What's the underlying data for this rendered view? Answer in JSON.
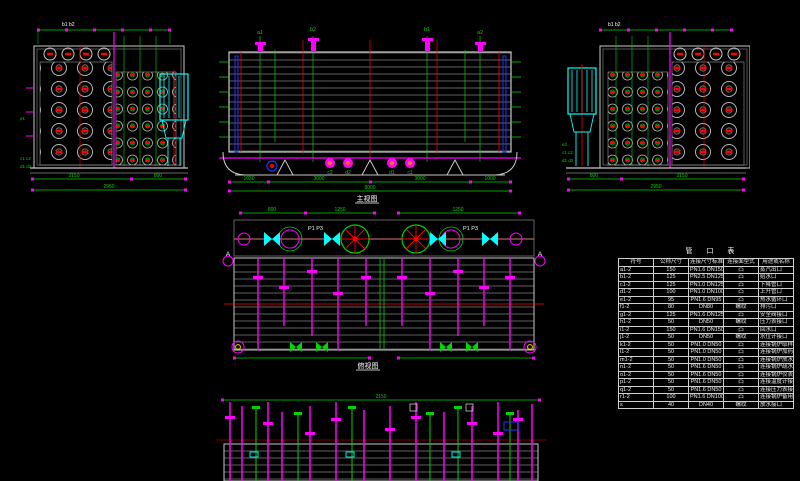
{
  "colors": {
    "background": "#000000",
    "dimension_green": "#00d400",
    "pipe_magenta": "#ff00ff",
    "centerline_red": "#ff0000",
    "economizer_cyan": "#00ffff",
    "tube_gray": "#b0b0b0",
    "outline_white": "#ffffff",
    "accent_blue": "#2233ff",
    "accent_yellow": "#ffd400"
  },
  "views": {
    "left_end": {
      "labels": {
        "t1": "b1 b2",
        "l1": "e1",
        "l2": "c1 c2",
        "l3": "d1 d2"
      },
      "dims": {
        "a": "2150",
        "b": "800",
        "total": "2950"
      }
    },
    "main": {
      "label": "主视图",
      "nozzles": {
        "n1": "a1",
        "n2": "b2",
        "n3": "b1",
        "n4": "a2",
        "f1": "c2",
        "f2": "d2",
        "f3": "d1",
        "f4": "c1"
      },
      "dims": {
        "s1": "1030",
        "s2": "3000",
        "s3": "3000",
        "s4": "1000",
        "total": "8000"
      }
    },
    "right_end": {
      "labels": {
        "t1": "b1 b2",
        "l1": "e2",
        "l2": "c1 c2",
        "l3": "d1 d2"
      },
      "dims": {
        "a": "800",
        "b": "2150",
        "total": "2950"
      }
    },
    "plan": {
      "label": "俯视图",
      "labels": {
        "pl": "P1 P3",
        "pr": "P1 P3",
        "a_left": "A",
        "a_right": "A"
      },
      "dims": {
        "d1": "800",
        "d2": "1250",
        "d3": "1250",
        "d4": "100"
      }
    },
    "bottom": {
      "dims": {
        "d1": "2150"
      }
    }
  },
  "table": {
    "title": "管 口 表",
    "headers": [
      "符号",
      "公称尺寸",
      "连接尺寸标准",
      "连接面型式",
      "用途或名称"
    ],
    "rows": [
      [
        "a1-2",
        "150",
        "PN1.6 DN150",
        "凸",
        "蒸汽出口"
      ],
      [
        "b1-2",
        "125",
        "PN2.5 DN125",
        "凸",
        "给水口"
      ],
      [
        "c1-2",
        "125",
        "PN1.0 DN125",
        "凸",
        "下降管口"
      ],
      [
        "d1-2",
        "100",
        "PN1.0 DN100",
        "凸",
        "上升管口"
      ],
      [
        "e1-2",
        "95",
        "PN1.6 DN95",
        "凸",
        "热水循环口"
      ],
      [
        "f1-2",
        "80",
        "DN80",
        "螺纹",
        "排污口"
      ],
      [
        "g1-2",
        "125",
        "PN1.6 DN125",
        "凸",
        "安全阀接口"
      ],
      [
        "h1-2",
        "50",
        "DN50",
        "螺纹",
        "压力表接口"
      ],
      [
        "i1-2",
        "150",
        "PN1.6 DN150",
        "凸",
        "回水口"
      ],
      [
        "j1-2",
        "50",
        "DN50",
        "螺纹",
        "水位计接口"
      ],
      [
        "k1-2",
        "50",
        "PN1.0 DN50",
        "凸",
        "连接锅炉取样接口"
      ],
      [
        "l1-2",
        "50",
        "PN1.0 DN50",
        "凸",
        "连接锅炉加药接口"
      ],
      [
        "m1-2",
        "50",
        "PN1.0 DN50",
        "凸",
        "连接锅炉放水接口"
      ],
      [
        "n1-2",
        "50",
        "PN1.6 DN50",
        "凸",
        "连接锅炉疏水接口"
      ],
      [
        "o1-2",
        "50",
        "PN1.6 DN50",
        "凸",
        "连接锅炉仪表接口"
      ],
      [
        "p1-2",
        "50",
        "PN1.6 DN50",
        "凸",
        "连接温度计接口"
      ],
      [
        "q1-2",
        "50",
        "PN1.6 DN50",
        "凸",
        "连接压力表接口"
      ],
      [
        "r1-2",
        "100",
        "PN1.6 DN100",
        "凸",
        "连接锅炉备用接口"
      ],
      [
        "s",
        "40",
        "DN40",
        "螺纹",
        "放水接口"
      ]
    ]
  }
}
